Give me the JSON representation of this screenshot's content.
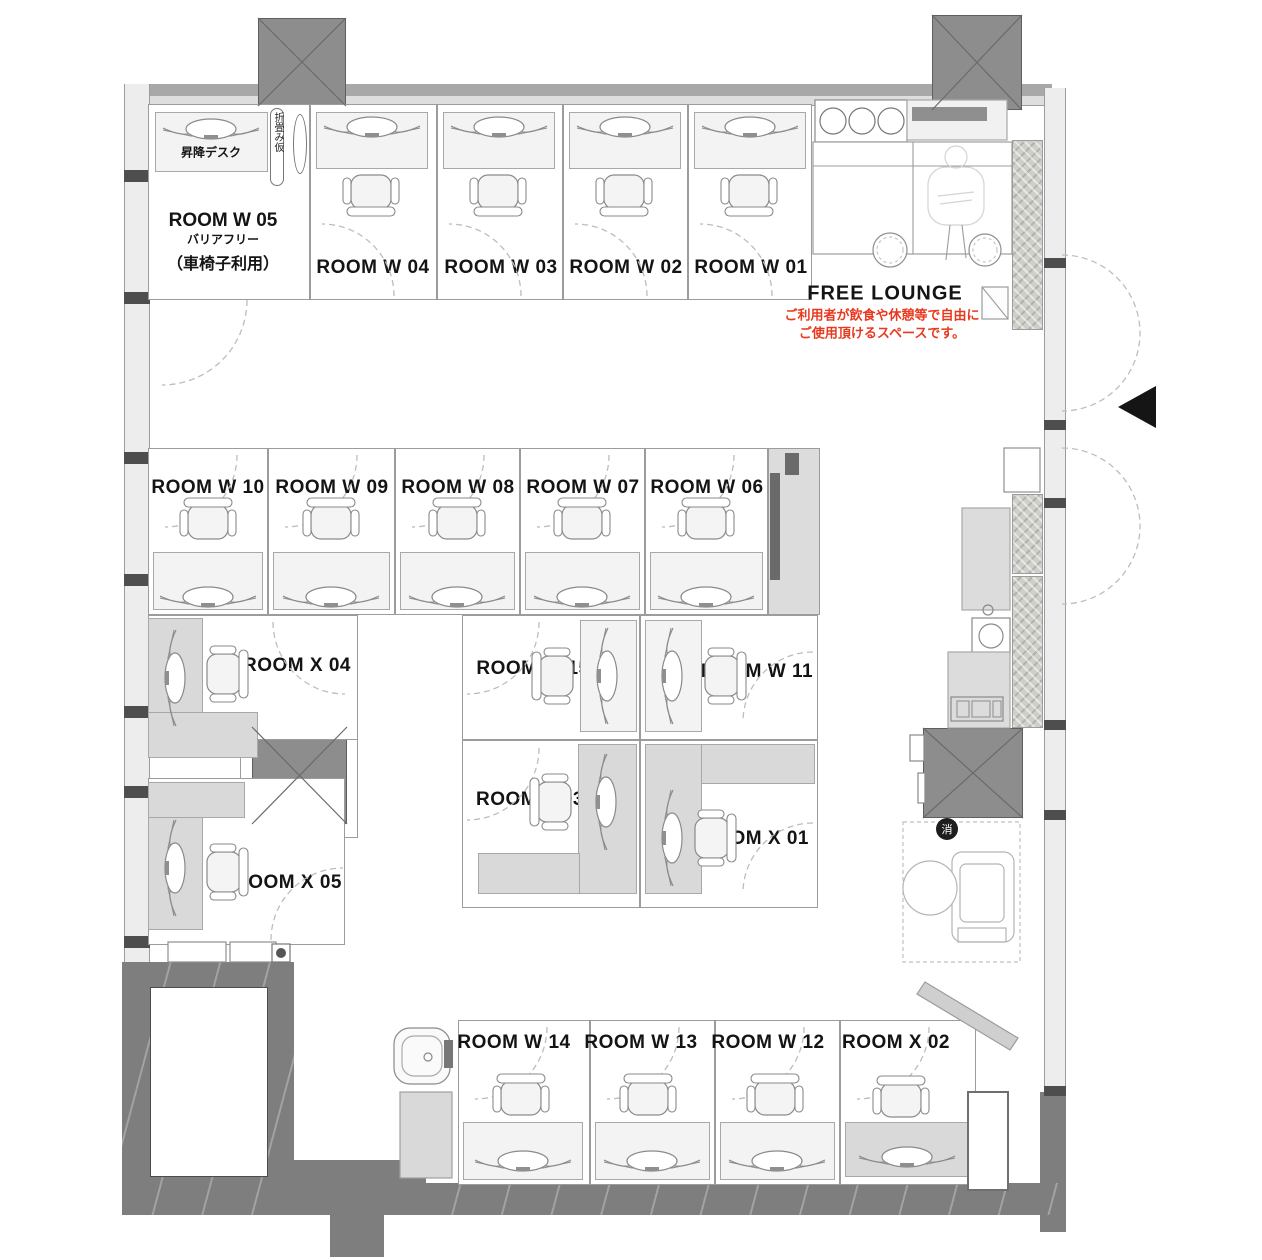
{
  "title": "office floor plan",
  "colors": {
    "wall": "#7e7e7e",
    "column": "#8d8d8d",
    "desk_gray": "#d9d9d9",
    "desk_light": "#f3f3f3",
    "line": "#9c9c9c",
    "accent_red": "#e8391f",
    "arc": "#bdbdbd",
    "badge_black": "#1d1d1d"
  },
  "labels": {
    "w05_title": "ROOM W 05",
    "w05_sub1": "バリアフリー",
    "w05_sub2": "（車椅子利用）",
    "lift_desk": "昇降デスク",
    "folding": "折畳み仮",
    "free_lounge": "FREE LOUNGE",
    "lounge_note1": "ご利用者が飲食や休憩等で自由に",
    "lounge_note2": "ご使用頂けるスペースです。",
    "fire_extinguisher": "消"
  },
  "rooms": [
    {
      "id": "room-w05",
      "label": "",
      "x": 148,
      "y": 104,
      "w": 162,
      "h": 196,
      "lx": 0,
      "ly": 0
    },
    {
      "id": "room-w04",
      "label": "ROOM W 04",
      "x": 310,
      "y": 104,
      "w": 127,
      "h": 196,
      "lx": 373,
      "ly": 268
    },
    {
      "id": "room-w03",
      "label": "ROOM W 03",
      "x": 437,
      "y": 104,
      "w": 126,
      "h": 196,
      "lx": 501,
      "ly": 268
    },
    {
      "id": "room-w02",
      "label": "ROOM W 02",
      "x": 563,
      "y": 104,
      "w": 125,
      "h": 196,
      "lx": 626,
      "ly": 268
    },
    {
      "id": "room-w01",
      "label": "ROOM W 01",
      "x": 688,
      "y": 104,
      "w": 124,
      "h": 196,
      "lx": 751,
      "ly": 268
    },
    {
      "id": "room-w10",
      "label": "ROOM W 10",
      "x": 148,
      "y": 448,
      "w": 120,
      "h": 167,
      "lx": 208,
      "ly": 488
    },
    {
      "id": "room-w09",
      "label": "ROOM W 09",
      "x": 268,
      "y": 448,
      "w": 127,
      "h": 167,
      "lx": 332,
      "ly": 488
    },
    {
      "id": "room-w08",
      "label": "ROOM W 08",
      "x": 395,
      "y": 448,
      "w": 125,
      "h": 167,
      "lx": 458,
      "ly": 488
    },
    {
      "id": "room-w07",
      "label": "ROOM W 07",
      "x": 520,
      "y": 448,
      "w": 125,
      "h": 167,
      "lx": 583,
      "ly": 488
    },
    {
      "id": "room-w06",
      "label": "ROOM W 06",
      "x": 645,
      "y": 448,
      "w": 123,
      "h": 167,
      "lx": 707,
      "ly": 488
    },
    {
      "id": "room-w15",
      "label": "ROOM W 15",
      "x": 462,
      "y": 615,
      "w": 178,
      "h": 125,
      "lx": 533,
      "ly": 669
    },
    {
      "id": "room-w11",
      "label": "ROOM W 11",
      "x": 640,
      "y": 615,
      "w": 178,
      "h": 125,
      "lx": 757,
      "ly": 672
    },
    {
      "id": "room-x03",
      "label": "ROOM X 03",
      "x": 462,
      "y": 740,
      "w": 178,
      "h": 168,
      "lx": 530,
      "ly": 800
    },
    {
      "id": "room-x01",
      "label": "ROOM X 01",
      "x": 640,
      "y": 740,
      "w": 178,
      "h": 168,
      "lx": 755,
      "ly": 839
    },
    {
      "id": "room-x04",
      "label": "ROOM X 04",
      "x": 148,
      "y": 615,
      "w": 210,
      "h": 125,
      "lx": 297,
      "ly": 666
    },
    {
      "id": "room-x05",
      "label": "ROOM X 05",
      "x": 148,
      "y": 778,
      "w": 197,
      "h": 167,
      "lx": 288,
      "ly": 883
    },
    {
      "id": "room-w14",
      "label": "ROOM W 14",
      "x": 458,
      "y": 1020,
      "w": 132,
      "h": 165,
      "lx": 514,
      "ly": 1043
    },
    {
      "id": "room-w13",
      "label": "ROOM W 13",
      "x": 590,
      "y": 1020,
      "w": 125,
      "h": 165,
      "lx": 641,
      "ly": 1043
    },
    {
      "id": "room-w12",
      "label": "ROOM W 12",
      "x": 715,
      "y": 1020,
      "w": 125,
      "h": 165,
      "lx": 768,
      "ly": 1043
    },
    {
      "id": "room-x02",
      "label": "ROOM X 02",
      "x": 840,
      "y": 1020,
      "w": 136,
      "h": 165,
      "lx": 896,
      "ly": 1043
    }
  ],
  "desks": [
    {
      "x": 155,
      "y": 112,
      "w": 113,
      "h": 60,
      "f": "light"
    },
    {
      "x": 316,
      "y": 112,
      "w": 112,
      "h": 57,
      "f": "light"
    },
    {
      "x": 443,
      "y": 112,
      "w": 112,
      "h": 57,
      "f": "light"
    },
    {
      "x": 569,
      "y": 112,
      "w": 112,
      "h": 57,
      "f": "light"
    },
    {
      "x": 694,
      "y": 112,
      "w": 112,
      "h": 57,
      "f": "light"
    },
    {
      "x": 153,
      "y": 552,
      "w": 110,
      "h": 58,
      "f": "light"
    },
    {
      "x": 273,
      "y": 552,
      "w": 117,
      "h": 58,
      "f": "light"
    },
    {
      "x": 400,
      "y": 552,
      "w": 115,
      "h": 58,
      "f": "light"
    },
    {
      "x": 525,
      "y": 552,
      "w": 115,
      "h": 58,
      "f": "light"
    },
    {
      "x": 650,
      "y": 552,
      "w": 113,
      "h": 58,
      "f": "light"
    },
    {
      "x": 580,
      "y": 620,
      "w": 57,
      "h": 112,
      "f": "light"
    },
    {
      "x": 645,
      "y": 620,
      "w": 57,
      "h": 112,
      "f": "light"
    },
    {
      "x": 578,
      "y": 744,
      "w": 59,
      "h": 150,
      "f": "gray"
    },
    {
      "x": 478,
      "y": 853,
      "w": 102,
      "h": 41,
      "f": "gray"
    },
    {
      "x": 645,
      "y": 744,
      "w": 170,
      "h": 40,
      "f": "gray"
    },
    {
      "x": 645,
      "y": 744,
      "w": 57,
      "h": 150,
      "f": "gray"
    },
    {
      "x": 148,
      "y": 618,
      "w": 55,
      "h": 112,
      "f": "gray"
    },
    {
      "x": 148,
      "y": 712,
      "w": 110,
      "h": 46,
      "f": "gray"
    },
    {
      "x": 148,
      "y": 782,
      "w": 55,
      "h": 148,
      "f": "gray"
    },
    {
      "x": 148,
      "y": 782,
      "w": 97,
      "h": 36,
      "f": "gray"
    },
    {
      "x": 463,
      "y": 1122,
      "w": 120,
      "h": 58,
      "f": "light"
    },
    {
      "x": 595,
      "y": 1122,
      "w": 115,
      "h": 58,
      "f": "light"
    },
    {
      "x": 720,
      "y": 1122,
      "w": 115,
      "h": 58,
      "f": "light"
    },
    {
      "x": 845,
      "y": 1122,
      "w": 125,
      "h": 55,
      "f": "gray"
    }
  ],
  "monitors": [
    {
      "cx": 211,
      "cy": 128,
      "rot": 0
    },
    {
      "cx": 372,
      "cy": 126,
      "rot": 0
    },
    {
      "cx": 499,
      "cy": 126,
      "rot": 0
    },
    {
      "cx": 625,
      "cy": 126,
      "rot": 0
    },
    {
      "cx": 750,
      "cy": 126,
      "rot": 0
    },
    {
      "cx": 208,
      "cy": 596,
      "rot": 0
    },
    {
      "cx": 331,
      "cy": 596,
      "rot": 0
    },
    {
      "cx": 457,
      "cy": 596,
      "rot": 0
    },
    {
      "cx": 582,
      "cy": 596,
      "rot": 0
    },
    {
      "cx": 706,
      "cy": 596,
      "rot": 0
    },
    {
      "cx": 608,
      "cy": 676,
      "rot": 90
    },
    {
      "cx": 673,
      "cy": 676,
      "rot": 90
    },
    {
      "cx": 607,
      "cy": 802,
      "rot": 90
    },
    {
      "cx": 673,
      "cy": 838,
      "rot": 90
    },
    {
      "cx": 176,
      "cy": 678,
      "rot": 90
    },
    {
      "cx": 176,
      "cy": 868,
      "rot": 90
    },
    {
      "cx": 523,
      "cy": 1160,
      "rot": 0
    },
    {
      "cx": 652,
      "cy": 1160,
      "rot": 0
    },
    {
      "cx": 777,
      "cy": 1160,
      "rot": 0
    },
    {
      "cx": 907,
      "cy": 1156,
      "rot": 0
    }
  ],
  "chairs": [
    {
      "cx": 371,
      "cy": 192,
      "rot": 0
    },
    {
      "cx": 498,
      "cy": 192,
      "rot": 0
    },
    {
      "cx": 624,
      "cy": 192,
      "rot": 0
    },
    {
      "cx": 749,
      "cy": 192,
      "rot": 0
    },
    {
      "cx": 208,
      "cy": 522,
      "rot": 180
    },
    {
      "cx": 331,
      "cy": 522,
      "rot": 180
    },
    {
      "cx": 457,
      "cy": 522,
      "rot": 180
    },
    {
      "cx": 582,
      "cy": 522,
      "rot": 180
    },
    {
      "cx": 706,
      "cy": 522,
      "rot": 180
    },
    {
      "cx": 556,
      "cy": 676,
      "rot": 90
    },
    {
      "cx": 722,
      "cy": 676,
      "rot": 270
    },
    {
      "cx": 554,
      "cy": 802,
      "rot": 90
    },
    {
      "cx": 712,
      "cy": 838,
      "rot": 270
    },
    {
      "cx": 224,
      "cy": 674,
      "rot": 270
    },
    {
      "cx": 224,
      "cy": 872,
      "rot": 270
    },
    {
      "cx": 521,
      "cy": 1098,
      "rot": 180
    },
    {
      "cx": 648,
      "cy": 1098,
      "rot": 180
    },
    {
      "cx": 775,
      "cy": 1098,
      "rot": 180
    },
    {
      "cx": 901,
      "cy": 1100,
      "rot": 180
    }
  ],
  "arcs": [
    "M394 296 A72 72 0 0 0 322 224",
    "M521 296 A72 72 0 0 0 449 224",
    "M647 296 A72 72 0 0 0 575 224",
    "M772 296 A72 72 0 0 0 700 224",
    "M247 300 A85 85 0 0 1 162 385",
    "M237 455 A72 72 0 0 1 165 527",
    "M357 455 A72 72 0 0 1 285 527",
    "M484 455 A72 72 0 0 1 412 527",
    "M609 455 A72 72 0 0 1 537 527",
    "M734 455 A72 72 0 0 1 662 527",
    "M539 622 A72 72 0 0 1 467 694",
    "M813 652 A70 70 0 0 0 743 722",
    "M539 748 A72 72 0 0 1 467 820",
    "M813 823 A70 70 0 0 0 743 893",
    "M273 622 A72 72 0 0 0 345 694",
    "M271 940 A72 72 0 0 1 343 868",
    "M547 1027 A72 72 0 0 1 475 1099",
    "M679 1027 A72 72 0 0 1 607 1099",
    "M804 1027 A72 72 0 0 1 732 1099",
    "M929 1027 A72 72 0 0 1 857 1099",
    "M1062 255 A78 78 0 0 1 1062 411",
    "M1062 448 A78 78 0 0 1 1062 604"
  ],
  "svg_rects": [
    {
      "x": 815,
      "y": 100,
      "w": 92,
      "h": 42,
      "f": "#ffffff",
      "s": "#8a8a8a"
    },
    {
      "x": 907,
      "y": 100,
      "w": 100,
      "h": 40,
      "f": "#f1f1f1",
      "s": "#a8a8a8"
    },
    {
      "x": 912,
      "y": 107,
      "w": 75,
      "h": 14,
      "f": "#8f8f8f",
      "s": "none"
    },
    {
      "x": 813,
      "y": 142,
      "w": 199,
      "h": 112,
      "f": "#ffffff",
      "s": "#9c9c9c"
    },
    {
      "x": 982,
      "y": 287,
      "w": 26,
      "h": 32,
      "f": "#fdfdfd",
      "s": "#9c9c9c"
    },
    {
      "x": 1004,
      "y": 448,
      "w": 36,
      "h": 44,
      "f": "#ffffff",
      "s": "#8f8f8f"
    },
    {
      "x": 962,
      "y": 508,
      "w": 48,
      "h": 102,
      "f": "#dcdcdc",
      "s": "#a8a8a8"
    },
    {
      "x": 972,
      "y": 618,
      "w": 38,
      "h": 36,
      "f": "#ffffff",
      "s": "#8a8a8a"
    },
    {
      "x": 948,
      "y": 652,
      "w": 62,
      "h": 76,
      "f": "#dcdcdc",
      "s": "#a8a8a8"
    },
    {
      "x": 951,
      "y": 697,
      "w": 52,
      "h": 24,
      "f": "none",
      "s": "#8a8a8a"
    },
    {
      "x": 957,
      "y": 701,
      "w": 12,
      "h": 16,
      "f": "none",
      "s": "#9a9a9a"
    },
    {
      "x": 972,
      "y": 701,
      "w": 18,
      "h": 16,
      "f": "none",
      "s": "#9a9a9a"
    },
    {
      "x": 993,
      "y": 701,
      "w": 8,
      "h": 16,
      "f": "none",
      "s": "#9a9a9a"
    },
    {
      "x": 903,
      "y": 822,
      "w": 117,
      "h": 140,
      "f": "none",
      "s": "#c0c0c0",
      "dash": "4 3"
    },
    {
      "x": 952,
      "y": 852,
      "w": 62,
      "h": 90,
      "rx": 10,
      "f": "#ffffff",
      "s": "#b5b5b5"
    },
    {
      "x": 960,
      "y": 864,
      "w": 44,
      "h": 58,
      "rx": 6,
      "f": "none",
      "s": "#b5b5b5"
    },
    {
      "x": 958,
      "y": 928,
      "w": 48,
      "h": 14,
      "f": "none",
      "s": "#b5b5b5"
    },
    {
      "x": 394,
      "y": 1028,
      "w": 56,
      "h": 56,
      "rx": 16,
      "f": "#fafafa",
      "s": "#8a8a8a"
    },
    {
      "x": 402,
      "y": 1036,
      "w": 40,
      "h": 40,
      "rx": 12,
      "f": "none",
      "s": "#aaaaaa"
    },
    {
      "x": 444,
      "y": 1040,
      "w": 9,
      "h": 28,
      "f": "#777777",
      "s": "none"
    },
    {
      "x": 400,
      "y": 1092,
      "w": 52,
      "h": 86,
      "f": "#d9d9d9",
      "s": "#a0a0a0"
    },
    {
      "x": 168,
      "y": 942,
      "w": 58,
      "h": 20,
      "f": "#ffffff",
      "s": "#8f8f8f"
    },
    {
      "x": 230,
      "y": 942,
      "w": 46,
      "h": 20,
      "f": "#ffffff",
      "s": "#8f8f8f"
    },
    {
      "x": 272,
      "y": 944,
      "w": 18,
      "h": 18,
      "f": "#ffffff",
      "s": "#777777"
    },
    {
      "x": 968,
      "y": 1092,
      "w": 40,
      "h": 98,
      "f": "#ffffff",
      "s": "#6f6f6f",
      "wd": 2
    },
    {
      "x": 770,
      "y": 473,
      "w": 10,
      "h": 107,
      "f": "#6a6a6a",
      "s": "none"
    },
    {
      "x": 785,
      "y": 453,
      "w": 14,
      "h": 22,
      "f": "#6a6a6a",
      "s": "none"
    },
    {
      "x": 910,
      "y": 735,
      "w": 14,
      "h": 26,
      "f": "#ffffff",
      "s": "#8a8a8a"
    },
    {
      "x": 918,
      "y": 773,
      "w": 7,
      "h": 30,
      "f": "#ffffff",
      "s": "#8a8a8a"
    },
    {
      "x": 928,
      "y": 167,
      "w": 56,
      "h": 58,
      "rx": 18,
      "f": "none",
      "s": "#d4d4d4"
    }
  ],
  "svg_lines": [
    {
      "x1": 813,
      "y1": 166,
      "x2": 1012,
      "y2": 166
    },
    {
      "x1": 913,
      "y1": 142,
      "x2": 913,
      "y2": 254
    },
    {
      "x1": 982,
      "y1": 287,
      "x2": 1008,
      "y2": 319
    },
    {
      "x1": 950,
      "y1": 225,
      "x2": 946,
      "y2": 260
    },
    {
      "x1": 962,
      "y1": 225,
      "x2": 966,
      "y2": 258
    }
  ],
  "svg_circles": [
    {
      "cx": 833,
      "cy": 121,
      "r": 13,
      "s": "#777777",
      "f": "#ffffff"
    },
    {
      "cx": 862,
      "cy": 121,
      "r": 13,
      "s": "#777777",
      "f": "#ffffff"
    },
    {
      "cx": 891,
      "cy": 121,
      "r": 13,
      "s": "#777777",
      "f": "#ffffff"
    },
    {
      "cx": 890,
      "cy": 250,
      "r": 17,
      "s": "#8f8f8f",
      "f": "#ffffff"
    },
    {
      "cx": 890,
      "cy": 250,
      "r": 13,
      "s": "#c6c6c6",
      "f": "none",
      "dash": "3 3"
    },
    {
      "cx": 985,
      "cy": 250,
      "r": 16,
      "s": "#8f8f8f",
      "f": "#ffffff"
    },
    {
      "cx": 985,
      "cy": 250,
      "r": 12,
      "s": "#c6c6c6",
      "f": "none",
      "dash": "3 3"
    },
    {
      "cx": 991,
      "cy": 636,
      "r": 12,
      "s": "#8a8a8a",
      "f": "none"
    },
    {
      "cx": 988,
      "cy": 610,
      "r": 5,
      "s": "#8a8a8a",
      "f": "none"
    },
    {
      "cx": 930,
      "cy": 888,
      "r": 27,
      "s": "#b5b5b5",
      "f": "#ffffff"
    },
    {
      "cx": 281,
      "cy": 953,
      "r": 5,
      "s": "none",
      "f": "#555555"
    },
    {
      "cx": 428,
      "cy": 1057,
      "r": 4,
      "s": "#8a8a8a",
      "f": "none"
    },
    {
      "cx": 956,
      "cy": 157,
      "r": 11,
      "s": "#d4d4d4",
      "f": "none"
    }
  ],
  "triangle": "1156,386 1156,428 1118,407",
  "diagonal_wall": "925,982 1018,1038 1010,1050 917,994",
  "badge": {
    "cx": 947,
    "cy": 829,
    "r": 11
  }
}
